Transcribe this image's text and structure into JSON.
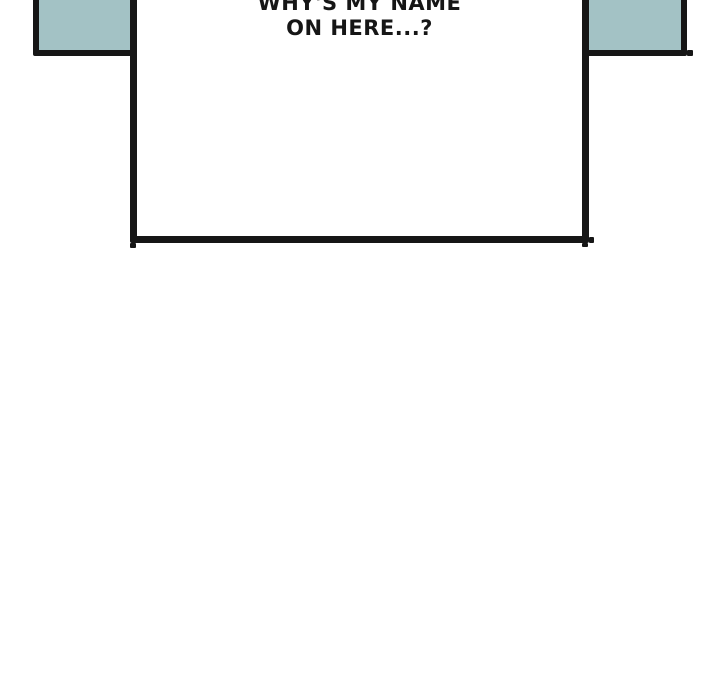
{
  "speech_bubble": {
    "lines": [
      "WHY'S MY NAME",
      "ON HERE...?"
    ]
  },
  "colors": {
    "panel_fill": "#a3c2c5",
    "bubble_fill": "#ffffff",
    "ink": "#161616",
    "page_background": "#ffffff"
  }
}
